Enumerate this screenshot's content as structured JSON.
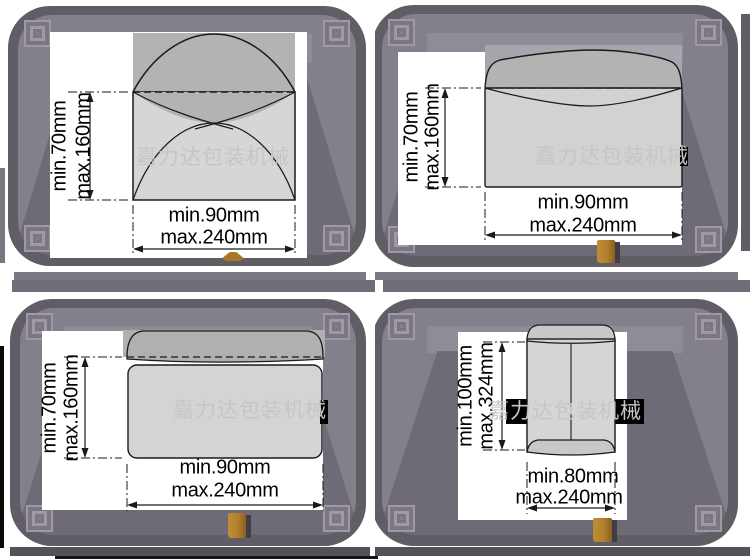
{
  "watermark": "嘉力达包装机械",
  "colors": {
    "machine_gray": "#605d65",
    "machine_surface": "#837f8b",
    "envelope_body": "#d6d6d6",
    "envelope_flap": "#b3b3b3",
    "belt_black": "#000000",
    "peg_brown": "#b1802f",
    "watermark_gray": "#c6c6c6",
    "line_black": "#1a1a1a"
  },
  "panels": [
    {
      "name": "envelope-open-pointed-flap",
      "height_dim": {
        "min": "min.70mm",
        "max": "max.160mm"
      },
      "width_dim": {
        "min": "min.90mm",
        "max": "max.240mm"
      }
    },
    {
      "name": "envelope-open-straight-flap",
      "height_dim": {
        "min": "min.70mm",
        "max": "max.160mm"
      },
      "width_dim": {
        "min": "min.90mm",
        "max": "max.240mm"
      }
    },
    {
      "name": "envelope-wallet-flap-open",
      "height_dim": {
        "min": "min.70mm",
        "max": "max.160mm"
      },
      "width_dim": {
        "min": "min.90mm",
        "max": "max.240mm"
      }
    },
    {
      "name": "envelope-vertical-pocket",
      "height_dim": {
        "min": "min.100mm",
        "max": "max.324mm"
      },
      "width_dim": {
        "min": "min.80mm",
        "max": "max.240mm"
      }
    }
  ]
}
